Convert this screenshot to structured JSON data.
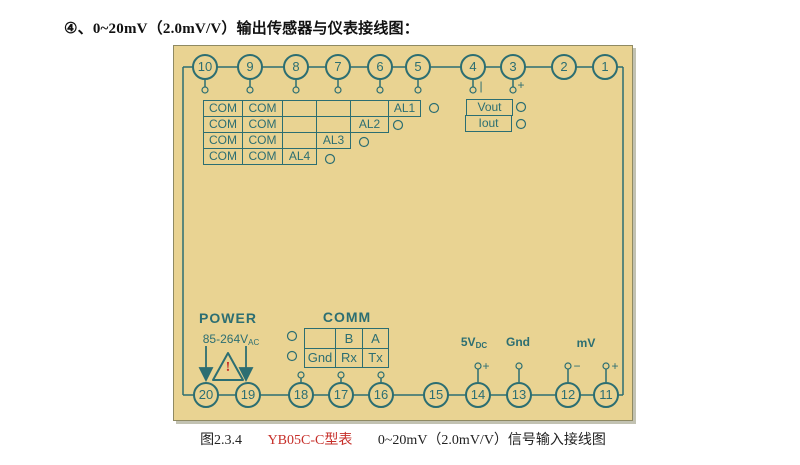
{
  "title": "④、0~20mV（2.0mV/V）输出传感器与仪表接线图：",
  "terminals": {
    "top": [
      "10",
      "9",
      "8",
      "7",
      "6",
      "5",
      "4",
      "3",
      "2",
      "1"
    ],
    "bottom": [
      "20",
      "19",
      "18",
      "17",
      "16",
      "15",
      "14",
      "13",
      "12",
      "11"
    ]
  },
  "signs": {
    "top_4": "|",
    "top_3": "+",
    "b14": "+",
    "b12": "−",
    "b11": "+"
  },
  "alarm_table": {
    "rows": [
      {
        "cells": [
          "COM",
          "COM",
          "",
          "",
          "",
          "AL1"
        ]
      },
      {
        "cells": [
          "COM",
          "COM",
          "",
          "",
          "AL2"
        ]
      },
      {
        "cells": [
          "COM",
          "COM",
          "",
          "AL3"
        ]
      },
      {
        "cells": [
          "COM",
          "COM",
          "AL4"
        ]
      }
    ]
  },
  "output_box": {
    "rows": [
      "Vout",
      "Iout"
    ]
  },
  "power": {
    "title": "POWER",
    "voltage": "85-264V",
    "voltage_sub": "AC",
    "warning": "!"
  },
  "comm": {
    "title": "COMM",
    "rows": [
      [
        "",
        "B",
        "A"
      ],
      [
        "Gnd",
        "Rx",
        "Tx"
      ]
    ]
  },
  "bottom_labels": {
    "v5": "5V",
    "v5_sub": "DC",
    "gnd": "Gnd",
    "mv": "mV"
  },
  "caption": {
    "figure": "图2.3.4",
    "model": "YB05C-C型表",
    "description": "0~20mV（2.0mV/V）信号输入接线图"
  },
  "colors": {
    "panel": "#e9d392",
    "line": "#2c6e72",
    "accent_red": "#c62f2a"
  }
}
